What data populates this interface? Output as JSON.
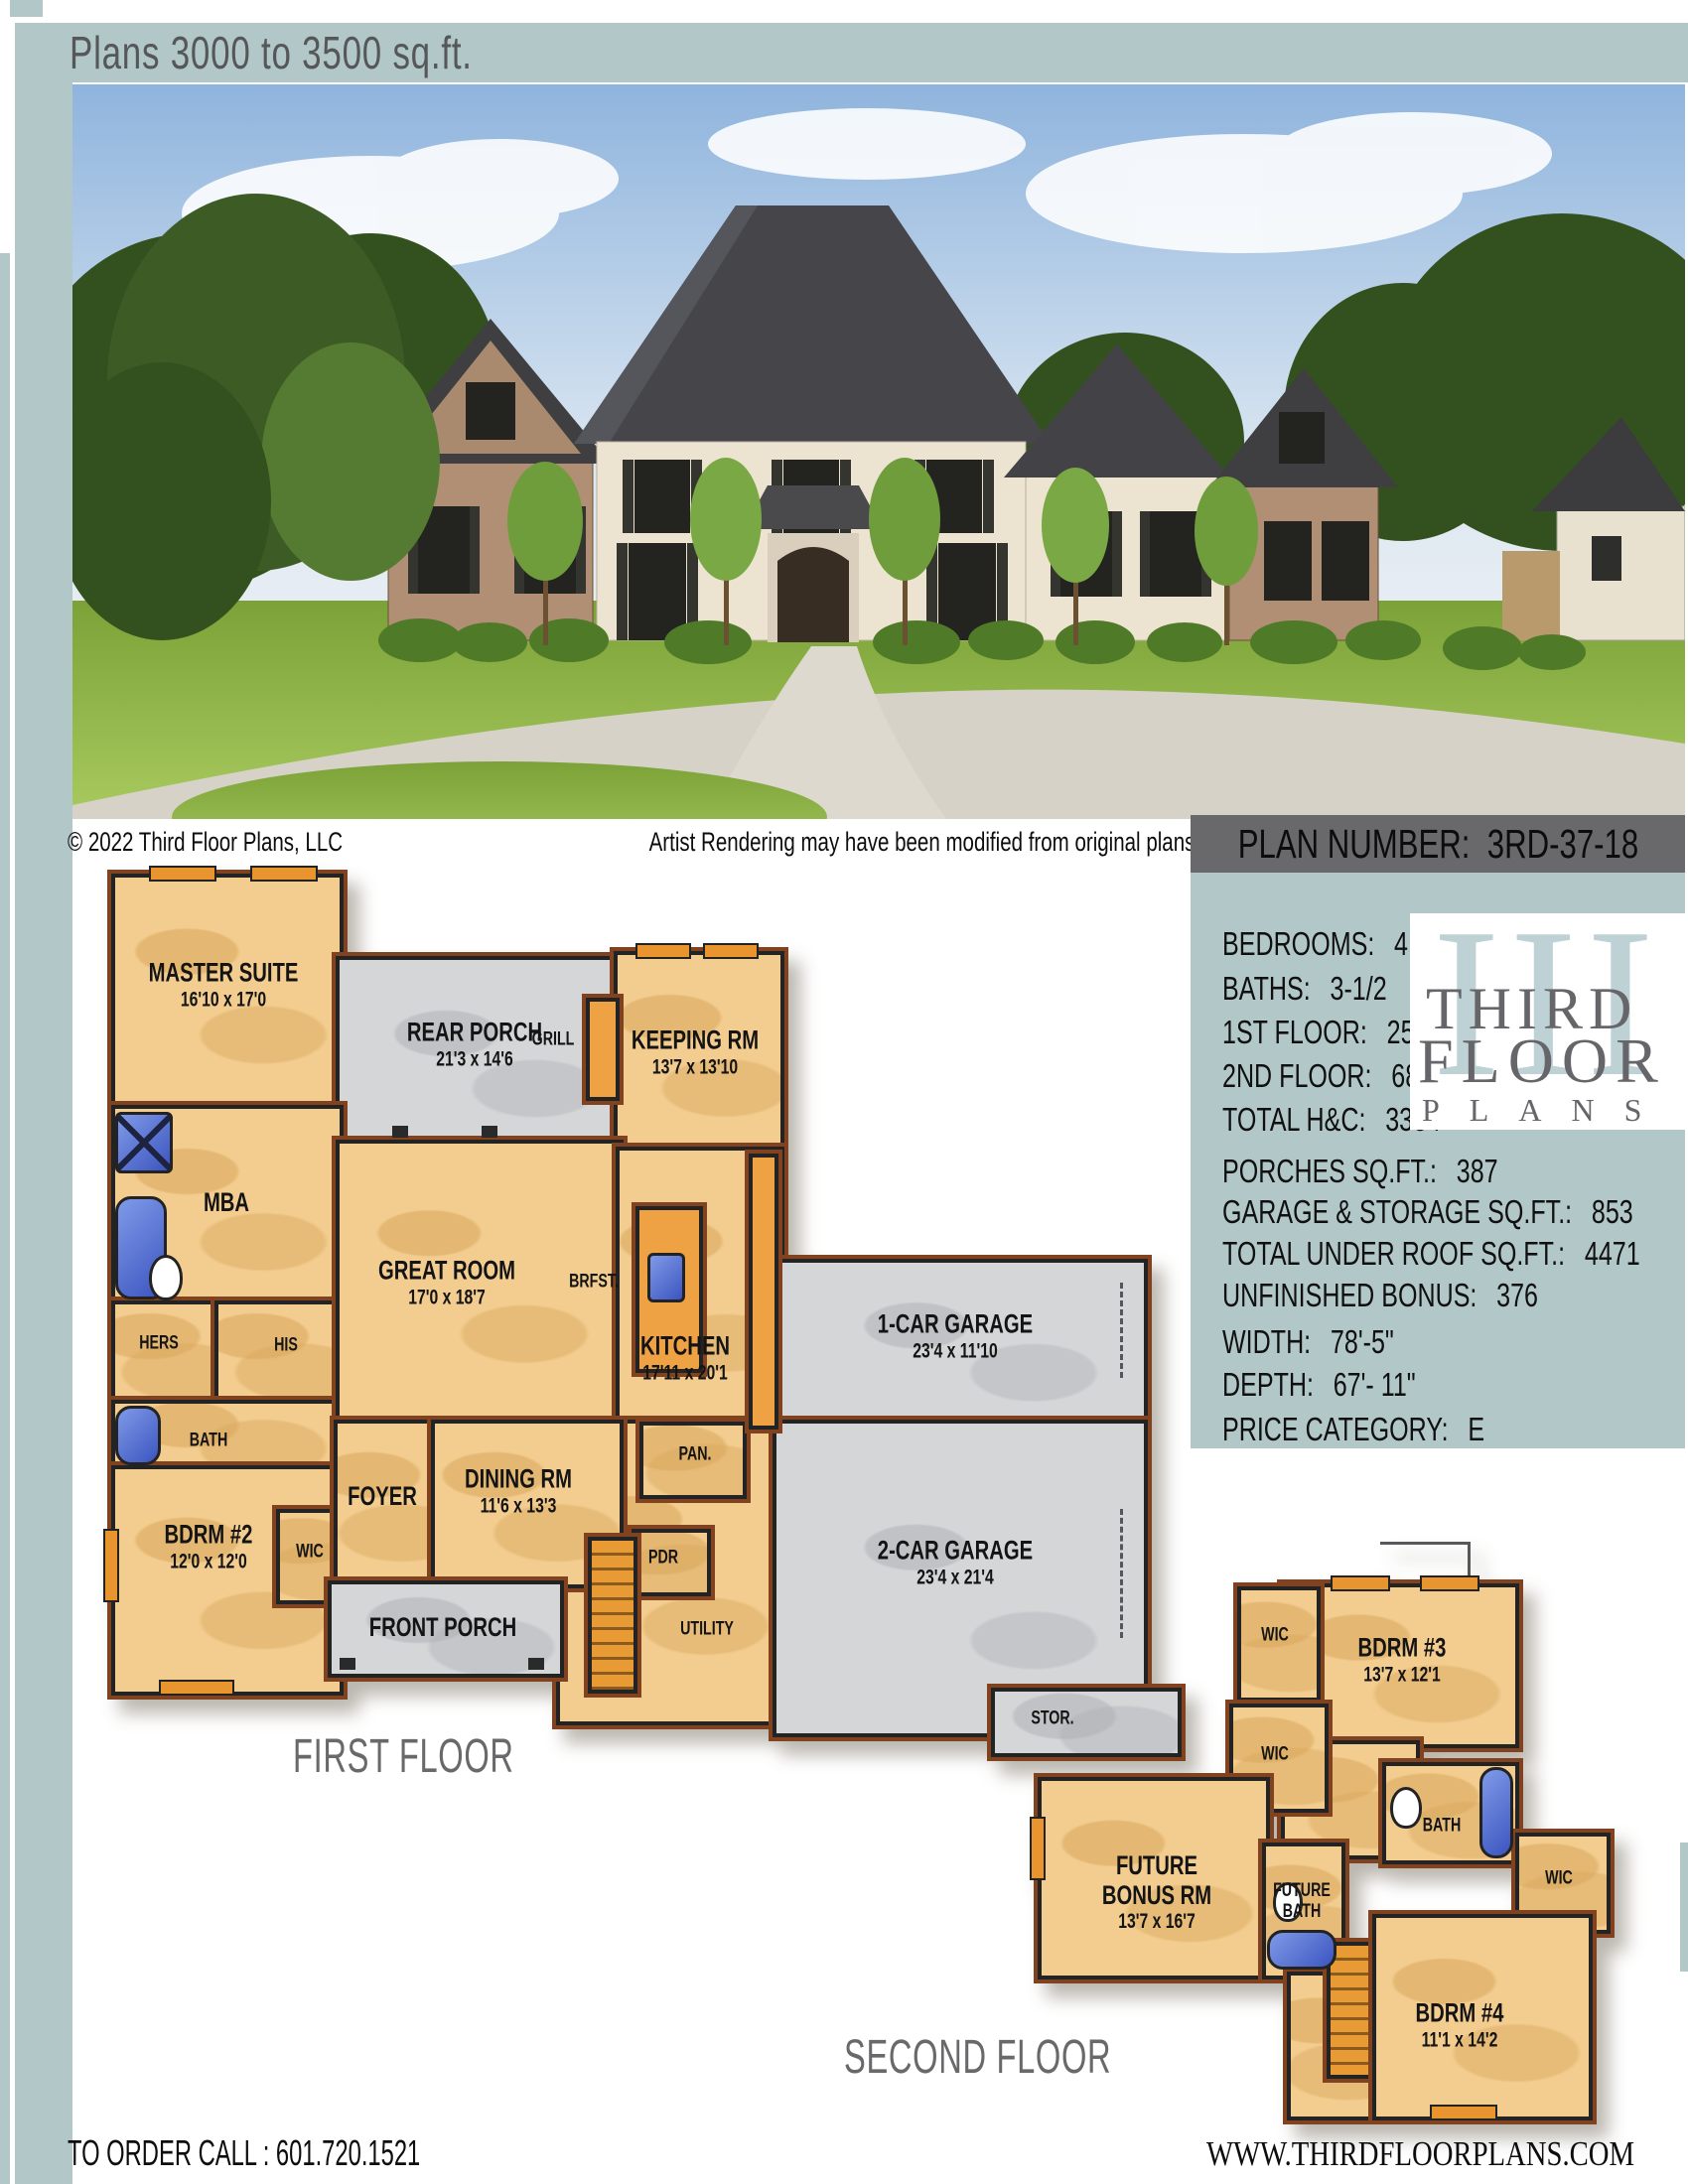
{
  "header": {
    "title": "Plans 3000 to 3500 sq.ft."
  },
  "photo": {
    "caption_left": "© 2022 Third Floor Plans, LLC",
    "caption_right": "Artist Rendering may have been modified from original plans"
  },
  "plan_number": {
    "label": "PLAN NUMBER:",
    "value": "3RD-37-18"
  },
  "specs": {
    "rows": [
      {
        "label": "BEDROOMS:",
        "value": "4"
      },
      {
        "label": "BATHS:",
        "value": "3-1/2"
      },
      {
        "label": "1ST FLOOR:",
        "value": "2550"
      },
      {
        "label": "2ND FLOOR:",
        "value": "681"
      },
      {
        "label": "TOTAL H&C:",
        "value": "3334"
      },
      {
        "label": "PORCHES SQ.FT.:",
        "value": "387"
      },
      {
        "label": "GARAGE & STORAGE SQ.FT.:",
        "value": "853"
      },
      {
        "label": "TOTAL UNDER ROOF SQ.FT.:",
        "value": "4471"
      },
      {
        "label": "UNFINISHED BONUS:",
        "value": "376"
      },
      {
        "label": "WIDTH:",
        "value": "78'-5\""
      },
      {
        "label": "DEPTH:",
        "value": "67'- 11\""
      },
      {
        "label": "PRICE CATEGORY:",
        "value": "E"
      }
    ]
  },
  "logo": {
    "numeral": "III",
    "word1": "THIRD",
    "word2": "FLOOR",
    "word3": "PLANS"
  },
  "first_floor": {
    "title": "FIRST FLOOR",
    "rooms": {
      "master": {
        "name": "MASTER SUITE",
        "dims": "16'10 x 17'0"
      },
      "rear_porch": {
        "name": "REAR PORCH",
        "dims": "21'3 x 14'6"
      },
      "grill": {
        "name": "GRILL"
      },
      "keeping": {
        "name": "KEEPING RM",
        "dims": "13'7 x 13'10"
      },
      "mba": {
        "name": "MBA"
      },
      "hers": {
        "name": "HERS"
      },
      "his": {
        "name": "HIS"
      },
      "bath": {
        "name": "BATH"
      },
      "bdrm2": {
        "name": "BDRM #2",
        "dims": "12'0 x 12'0"
      },
      "wic": {
        "name": "WIC"
      },
      "great": {
        "name": "GREAT ROOM",
        "dims": "17'0 x 18'7"
      },
      "brfst": {
        "name": "BRFST."
      },
      "kitchen": {
        "name": "KITCHEN",
        "dims": "17'11 x 20'1"
      },
      "pan": {
        "name": "PAN."
      },
      "foyer": {
        "name": "FOYER"
      },
      "dining": {
        "name": "DINING RM",
        "dims": "11'6 x 13'3"
      },
      "front_porch": {
        "name": "FRONT PORCH"
      },
      "pdr": {
        "name": "PDR"
      },
      "utility": {
        "name": "UTILITY"
      },
      "garage1": {
        "name": "1-CAR GARAGE",
        "dims": "23'4 x 11'10"
      },
      "garage2": {
        "name": "2-CAR GARAGE",
        "dims": "23'4 x 21'4"
      },
      "stor": {
        "name": "STOR."
      }
    }
  },
  "second_floor": {
    "title": "SECOND FLOOR",
    "rooms": {
      "wic_top": {
        "name": "WIC"
      },
      "bdrm3": {
        "name": "BDRM #3",
        "dims": "13'7 x 12'1"
      },
      "wic_mid": {
        "name": "WIC"
      },
      "bath": {
        "name": "BATH"
      },
      "bonus": {
        "name1": "FUTURE",
        "name2": "BONUS RM",
        "dims": "13'7 x 16'7"
      },
      "future_bath": {
        "name1": "FUTURE",
        "name2": "BATH"
      },
      "wic_right": {
        "name": "WIC"
      },
      "bdrm4": {
        "name": "BDRM #4",
        "dims": "11'1 x 14'2"
      }
    }
  },
  "footer": {
    "order": "TO ORDER CALL :  601.720.1521",
    "website": "WWW.THIRDFLOORPLANS.COM"
  },
  "colors": {
    "accent": "#b2c7c8",
    "bar_gray": "#69686a",
    "room_tan": "#f3cd90",
    "porch_gray": "#d5d6d8"
  }
}
